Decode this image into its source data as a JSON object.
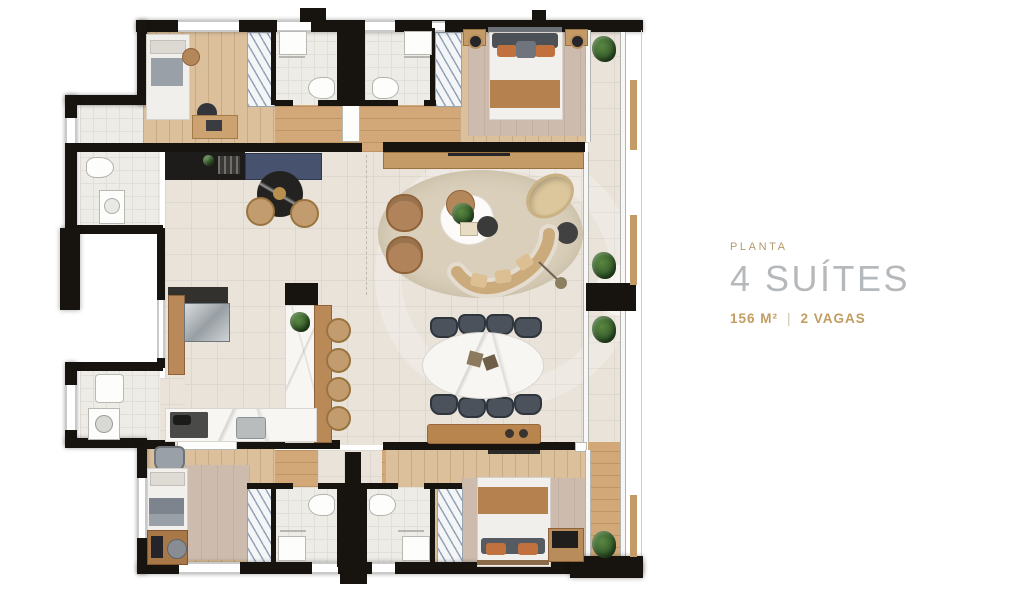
{
  "page": {
    "background": "#ffffff",
    "type": "apartment floor plan marketing slide"
  },
  "info": {
    "eyebrow": "PLANTA",
    "title": "4 SUÍTES",
    "area": "156 M²",
    "separator": "|",
    "parking": "2 VAGAS",
    "colors": {
      "eyebrow": "#b39a6b",
      "title": "#b6b9bc",
      "details": "#c29c60"
    }
  },
  "floorplan": {
    "colors": {
      "wall": "#17140f",
      "tile_floor": "#e9e3da",
      "wood_floor": "#dcc09c",
      "entry_wood": "#d2a878",
      "area_rug": "#cdbcae",
      "marble": "#f8f6f2",
      "navy_counter": "#46526e",
      "living_rug": "#d9cfba",
      "upholstery_tan": "#b0835a",
      "dining_chair": "#4b525b",
      "blanket_brown": "#b5824f",
      "pillow_orange": "#c0713d",
      "plant_green": "#3c6c33"
    }
  }
}
